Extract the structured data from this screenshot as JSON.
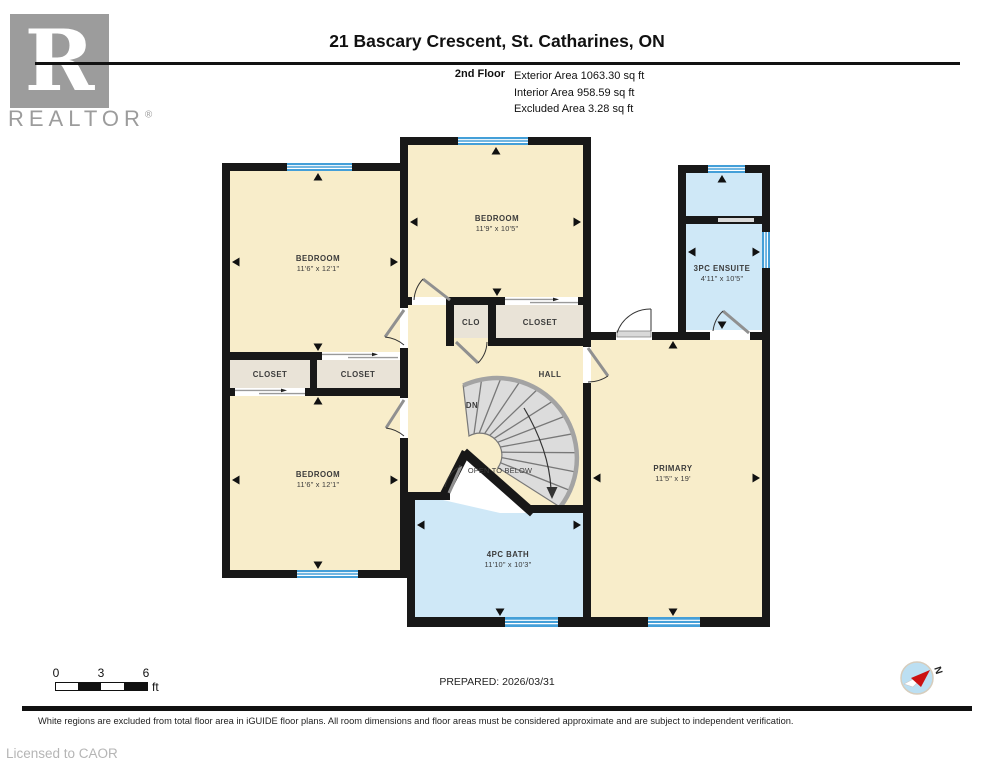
{
  "header": {
    "title": "21 Bascary Crescent, St. Catharines, ON",
    "floor_label": "2nd Floor",
    "exterior_area": "Exterior Area 1063.30 sq ft",
    "interior_area": "Interior Area 958.59 sq ft",
    "excluded_area": "Excluded Area 3.28 sq ft",
    "logo_letter": "R",
    "logo_word": "REALTOR",
    "logo_reg": "®"
  },
  "rooms": {
    "bedroom_tl": {
      "name": "BEDROOM",
      "dims": "11'6\" x 12'1\""
    },
    "bedroom_tm": {
      "name": "BEDROOM",
      "dims": "11'9\" x 10'5\""
    },
    "ensuite": {
      "name": "3PC ENSUITE",
      "dims": "4'11\" x 10'5\""
    },
    "clo": {
      "name": "CLO"
    },
    "closet_top": {
      "name": "CLOSET"
    },
    "closet_left": {
      "name": "CLOSET"
    },
    "closet_mid": {
      "name": "CLOSET"
    },
    "bedroom_bl": {
      "name": "BEDROOM",
      "dims": "11'6\" x 12'1\""
    },
    "hall": {
      "name": "HALL"
    },
    "primary": {
      "name": "PRIMARY",
      "dims": "11'5\" x 19'"
    },
    "bath": {
      "name": "4PC BATH",
      "dims": "11'10\" x 10'3\""
    },
    "stairs_label": "DN",
    "open_below": "OPEN TO BELOW"
  },
  "footer": {
    "scale": {
      "t0": "0",
      "t1": "3",
      "t2": "6",
      "unit": "ft"
    },
    "prepared": "PREPARED: 2026/03/31",
    "compass_n": "N",
    "disclaimer": "White regions are excluded from total floor area in iGUIDE floor plans. All room dimensions and floor areas must be considered approximate and are subject to independent verification.",
    "license": "Licensed to CAOR"
  },
  "colors": {
    "wall": "#181818",
    "cream": "#f8edca",
    "bath": "#cfe8f7",
    "closet": "#e9e3d7",
    "window": "#449fd8",
    "stair": "#dcdcdc",
    "accent-red": "#cc1111"
  }
}
